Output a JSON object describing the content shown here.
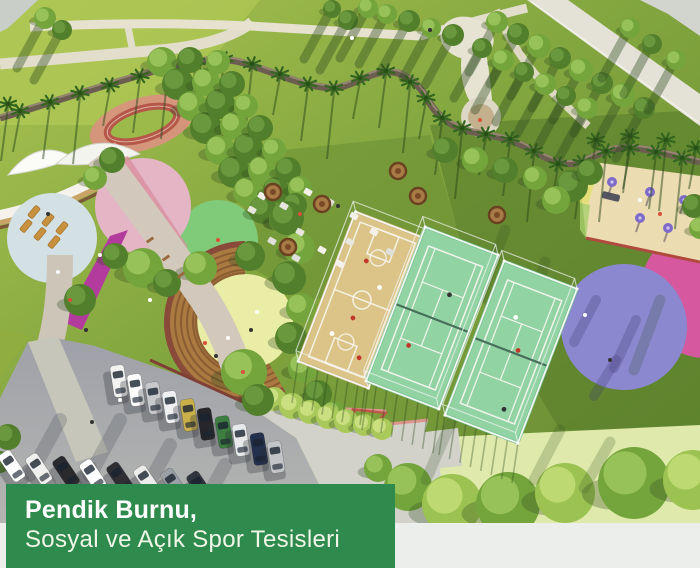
{
  "caption": {
    "line1": "Pendik Burnu,",
    "line2": "Sosyal ve Açık Spor Tesisleri"
  },
  "colors": {
    "caption_band_green": "#2E8B4D",
    "footer_gray": "#ECEEEC"
  },
  "image": {
    "kind": "aerial-architectural-render",
    "visible_features": [
      "park lawns with paths",
      "palm-lined serpentine wall",
      "sand basketball court",
      "two green tennis courts",
      "round amphitheater with lawn circle",
      "children playground",
      "parking lot with cars",
      "colored plaza circles",
      "picnic lawn",
      "white shade canopies",
      "running track"
    ]
  }
}
